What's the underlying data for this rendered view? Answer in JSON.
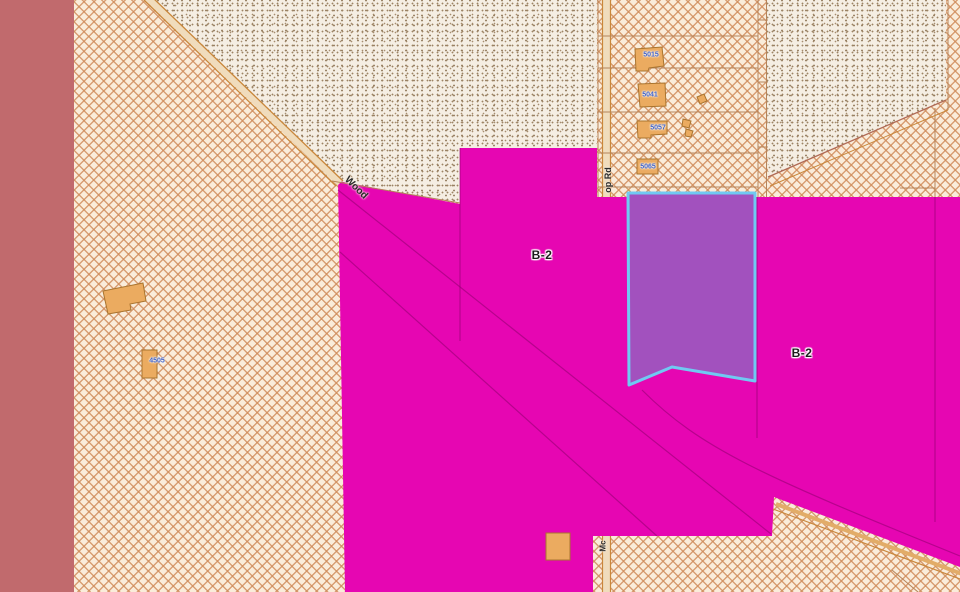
{
  "labels": {
    "zone_b2_center": "B-2",
    "zone_b2_right": "B-2",
    "road_wood": "Wood",
    "road_op_rd": "op Rd",
    "road_mc": "Mc",
    "addr_1": "5015",
    "addr_2": "5041",
    "addr_3": "5057",
    "addr_4": "5065",
    "addr_5": "4505"
  },
  "colors": {
    "zoning_b2_magenta": "#E606B2",
    "selected_parcel_purple": "#A251BE",
    "selection_outline_cyan": "#70C9F2",
    "left_zone_rose": "#C16A6D",
    "parcel_base_cream": "#FAECDA",
    "hatch_line_tan": "#CF8B5A",
    "stipple_dot_brown": "#9D8465",
    "road_edge_orange": "#C9873B",
    "building_fill_orange": "#EBAB60",
    "address_text_blue": "#3E5FC4"
  }
}
